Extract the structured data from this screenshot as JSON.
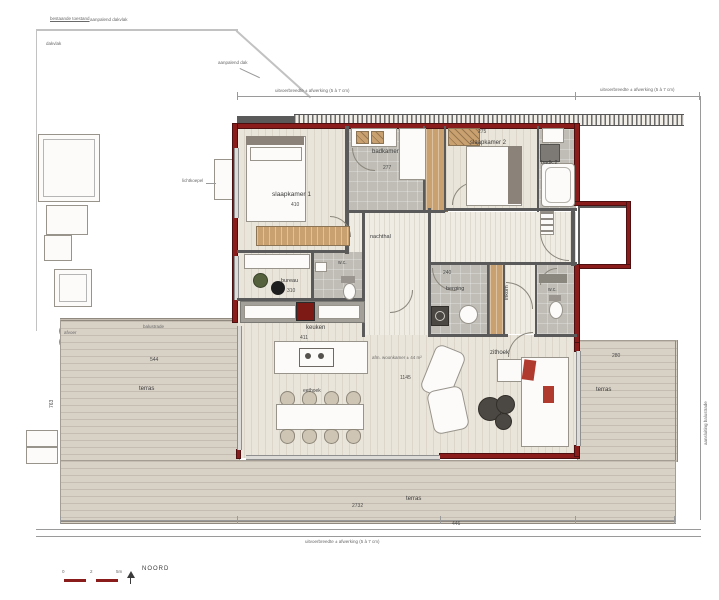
{
  "colors": {
    "exterior_wall_red": "#8a1c1c",
    "interior_wall_gray": "#5a5a5a",
    "floor_beige": "#eae5da",
    "tile_gray": "#bfbdb6",
    "terrace_decking": "#d8d1c6",
    "wood_closet_tan": "#c9a070",
    "accent_cushion_red": "#b03a2e"
  },
  "plan": {
    "rooms": {
      "slaapkamer1": {
        "label": "slaapkamer 1",
        "dim": "410"
      },
      "badkamer": {
        "label": "badkamer",
        "dim": "277"
      },
      "slaapkamer2": {
        "label": "slaapkamer 2",
        "dim": "275"
      },
      "badk2": {
        "label": "badk.2"
      },
      "nachthal": {
        "label": "nachthal"
      },
      "bureau": {
        "label": "bureau",
        "dim": "310"
      },
      "wc1": {
        "label": "w.c."
      },
      "berging": {
        "label": "berging",
        "dim": "240"
      },
      "inkom": {
        "label": "inkom"
      },
      "wc2": {
        "label": "w.c."
      },
      "keuken": {
        "label": "keuken",
        "dim": "411"
      },
      "eethoek": {
        "label": "eethoek"
      },
      "zithoek": {
        "label": "zithoek"
      }
    },
    "terraces": {
      "left": {
        "label": "terras",
        "dim": "544",
        "vdim": "763"
      },
      "right": {
        "label": "terras",
        "dim": "280"
      },
      "bottom": {
        "label": "terras",
        "dim": "2732"
      }
    },
    "annotations": {
      "dim_note": "uitvoerbreedte ± afwerking (5 à 7 cm)",
      "balustrade": "balustrade",
      "top_far_left": "bestaande toestand",
      "top_left": "aanpalend dakvlak",
      "roof": "dakvlak",
      "skylight": "lichtkoepel",
      "top_right": "aanpalend dak",
      "right_edge": "aansluiting balustrade",
      "living_note": "afm. woonkamer ± 44 m²",
      "living_dim": "1145",
      "drain": "afvoer",
      "bottom_dim": "446"
    },
    "compass": {
      "north": "NOORD",
      "ticks": [
        "0",
        "2",
        "5m"
      ]
    }
  }
}
